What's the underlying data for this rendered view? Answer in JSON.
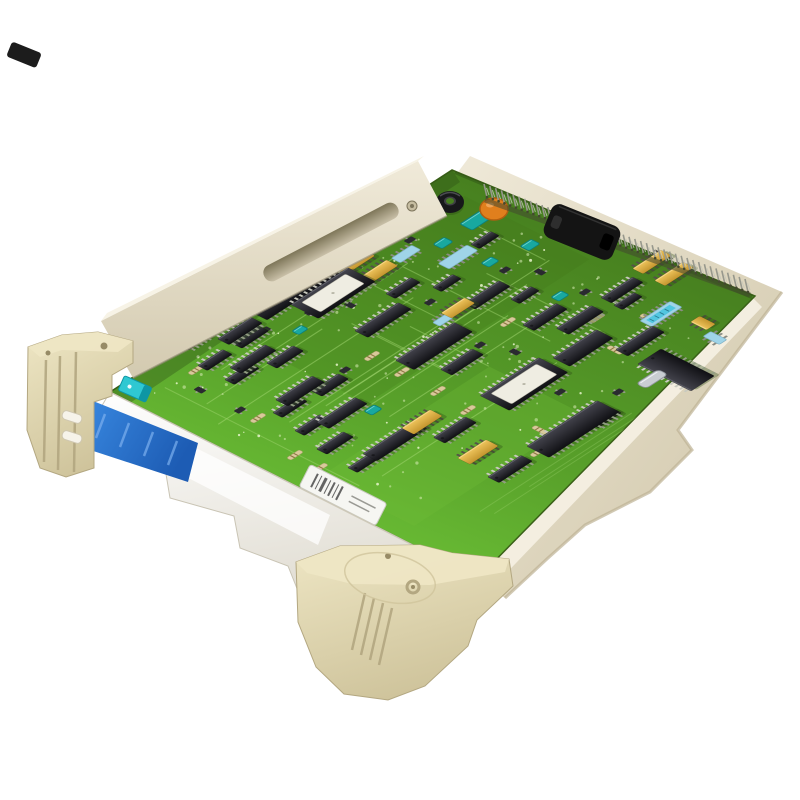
{
  "image": {
    "type": "product-photo",
    "subject": "industrial-plc-circuit-board-module",
    "background": "#ffffff"
  },
  "palette": {
    "board_top": "#47801f",
    "board_mid": "#58a02a",
    "board_front": "#6ec437",
    "board_edge": "#3a6018",
    "trace": "#a4d873",
    "pour_light": "#6fbe39",
    "pour_dark": "#3f7419",
    "via": "#d9edb7",
    "sparkle": "#e9f6cd",
    "shadow_green": "#2c4a14",
    "bracket_face1": "#f0ead9",
    "bracket_face2": "#d3cab0",
    "bracket_top": "#f7f3e6",
    "bracket_edge": "#8f8872",
    "slot_dark": "#7e7659",
    "slot_light": "#c9c0a8",
    "screw": "#c6bda1",
    "screw_dark": "#7d755c",
    "rail_east1": "#efe9d8",
    "rail_east2": "#cfc5a8",
    "rail_east_hi": "#f4efe1",
    "rail_east_shade": "#bdb294",
    "rail_front1": "#ffffff",
    "rail_front2": "#dfdbd0",
    "rail_front_glare": "#ffffff",
    "rail_front_edge": "#c9c4b4",
    "clip1": "#eee6c4",
    "clip2": "#cfc49c",
    "clip_line": "#b3a781",
    "clip_deep": "#978b66",
    "peg": "#f6f3ea",
    "peg_edge": "#cfc7b0",
    "pin": "#97988d",
    "pin_dark": "#43482f",
    "pin_light": "#c6c7ba",
    "handle": "#141414",
    "handle_hi": "#3a3a3a",
    "handle_notch": "#2e2e2e",
    "chip_top": "#44444d",
    "chip_bottom": "#101014",
    "chip_hi": "#6a6a74",
    "chip_pin": "#c9cabf",
    "yellow1": "#f0c65e",
    "yellow2": "#c4952e",
    "yellow_pin": "#55524a",
    "teal": "#18a8a0",
    "teal_dark": "#0d7f7a",
    "lightblue": "#9fd4e8",
    "lightblue_edge": "#7fb0c4",
    "cyanlabel": "#52c6e0",
    "cyanlabel_tick": "#2a7a90",
    "orange": "#e07f1d",
    "orange_dark": "#b05f10",
    "silver": "#c9cdd2",
    "silver_edge": "#8f959c",
    "resistor": "#d9c99b",
    "resistor_band": "#8a7340",
    "smd": "#2a2a30",
    "blue1": "#3a8ae2",
    "blue2": "#1d5cb4",
    "blue_streak": "#7cb0ef",
    "cyan_conn": "#2fc8d2",
    "cyan_conn_dark": "#0e96a4",
    "label_white": "#f6f6f2",
    "label_edge": "#c9c9c0",
    "barcode": "#4a4a4a",
    "rust": "#9c5b1c"
  },
  "geometry": {
    "board_corners": [
      [
        452,
        170
      ],
      [
        755,
        296
      ],
      [
        478,
        578
      ],
      [
        110,
        392
      ]
    ],
    "board_origin": [
      110,
      392
    ],
    "board_u": [
      342,
      -222
    ],
    "board_v": [
      368,
      186
    ],
    "pins": {
      "from": [
        487,
        197
      ],
      "to": [
        748,
        292
      ],
      "count": 46
    },
    "rail_east": [
      [
        458,
        172
      ],
      [
        752,
        297
      ],
      [
        478,
        578
      ],
      [
        505,
        598
      ],
      [
        548,
        558
      ],
      [
        585,
        525
      ],
      [
        650,
        492
      ],
      [
        692,
        450
      ],
      [
        678,
        430
      ],
      [
        708,
        390
      ],
      [
        782,
        292
      ],
      [
        470,
        156
      ]
    ],
    "rail_east_highlight": [
      [
        752,
        297
      ],
      [
        478,
        578
      ],
      [
        492,
        588
      ],
      [
        762,
        307
      ]
    ],
    "rail_front": [
      [
        110,
        392
      ],
      [
        478,
        578
      ],
      [
        462,
        630
      ],
      [
        400,
        610
      ],
      [
        372,
        628
      ],
      [
        300,
        596
      ],
      [
        288,
        566
      ],
      [
        240,
        548
      ],
      [
        234,
        516
      ],
      [
        170,
        498
      ],
      [
        165,
        468
      ],
      [
        80,
        443
      ]
    ],
    "rail_front_glare": [
      [
        150,
        425
      ],
      [
        330,
        515
      ],
      [
        318,
        545
      ],
      [
        138,
        452
      ]
    ],
    "bracket": {
      "face": [
        [
          418,
          161
        ],
        [
          447,
          216
        ],
        [
          133,
          378
        ],
        [
          101,
          321
        ]
      ],
      "top": [
        [
          418,
          161
        ],
        [
          424,
          156
        ],
        [
          107,
          313
        ],
        [
          101,
          321
        ]
      ],
      "slot": {
        "cx": 331,
        "cy": 242,
        "l": 150,
        "w": 17,
        "angle": -27.5
      },
      "screw": [
        412,
        206
      ]
    },
    "handle": {
      "cx": 582,
      "cy": 232,
      "l": 74,
      "w": 36,
      "angle": 22,
      "mount": [
        612,
        272
      ]
    },
    "blue_strip": [
      [
        88,
        399
      ],
      [
        198,
        443
      ],
      [
        188,
        482
      ],
      [
        78,
        446
      ]
    ],
    "cyan_connector": {
      "x": 135,
      "y": 389,
      "l": 30,
      "w": 16,
      "angle": 24
    },
    "clip_left": {
      "face": [
        [
          28,
          347
        ],
        [
          62,
          335
        ],
        [
          98,
          332
        ],
        [
          133,
          341
        ],
        [
          133,
          363
        ],
        [
          112,
          375
        ],
        [
          112,
          396
        ],
        [
          94,
          402
        ],
        [
          94,
          468
        ],
        [
          66,
          477
        ],
        [
          40,
          468
        ],
        [
          27,
          430
        ]
      ],
      "top": [
        [
          28,
          347
        ],
        [
          62,
          335
        ],
        [
          98,
          332
        ],
        [
          133,
          341
        ],
        [
          118,
          352
        ],
        [
          62,
          350
        ],
        [
          40,
          357
        ]
      ],
      "ribs": [
        [
          46,
          360,
          44,
          462
        ],
        [
          60,
          356,
          58,
          470
        ],
        [
          76,
          352,
          74,
          472
        ]
      ],
      "holes": [
        [
          104,
          346,
          3.5
        ],
        [
          48,
          353,
          2.5
        ]
      ],
      "pegs": [
        [
          72,
          417
        ],
        [
          72,
          437
        ]
      ],
      "peg_angle": 18
    },
    "clip_bottom": {
      "face": [
        [
          296,
          562
        ],
        [
          340,
          546
        ],
        [
          420,
          545
        ],
        [
          452,
          553
        ],
        [
          509,
          559
        ],
        [
          513,
          586
        ],
        [
          477,
          620
        ],
        [
          468,
          646
        ],
        [
          425,
          686
        ],
        [
          388,
          700
        ],
        [
          344,
          694
        ],
        [
          316,
          667
        ],
        [
          298,
          622
        ]
      ],
      "top": [
        [
          296,
          562
        ],
        [
          340,
          546
        ],
        [
          420,
          545
        ],
        [
          452,
          553
        ],
        [
          509,
          559
        ],
        [
          505,
          572
        ],
        [
          430,
          585
        ],
        [
          352,
          584
        ],
        [
          307,
          573
        ]
      ],
      "ribs": [
        [
          365,
          593,
          352,
          650
        ],
        [
          374,
          598,
          361,
          655
        ],
        [
          383,
          603,
          370,
          660
        ],
        [
          392,
          608,
          379,
          665
        ]
      ],
      "hole_small": [
        388,
        556,
        3
      ],
      "hole_ring": [
        413,
        587,
        6
      ],
      "plate": [
        390,
        578,
        46,
        24,
        12
      ]
    },
    "texture": {
      "seed": 11,
      "vias": 75,
      "sparkles": 42,
      "traces_u": 11,
      "traces_v": 8
    }
  },
  "components": [
    {
      "t": "res",
      "x": 168,
      "y": 345,
      "o": "u"
    },
    {
      "t": "res",
      "x": 196,
      "y": 370,
      "o": "u"
    },
    {
      "t": "res",
      "x": 258,
      "y": 418,
      "o": "u"
    },
    {
      "t": "res",
      "x": 372,
      "y": 356,
      "o": "u"
    },
    {
      "t": "res",
      "x": 402,
      "y": 372,
      "o": "u"
    },
    {
      "t": "res",
      "x": 478,
      "y": 300,
      "o": "u"
    },
    {
      "t": "res",
      "x": 508,
      "y": 322,
      "o": "u"
    },
    {
      "t": "res",
      "x": 597,
      "y": 318,
      "o": "u"
    },
    {
      "t": "res",
      "x": 438,
      "y": 391,
      "o": "u"
    },
    {
      "t": "res",
      "x": 468,
      "y": 410,
      "o": "u"
    },
    {
      "t": "res",
      "x": 538,
      "y": 452,
      "o": "u"
    },
    {
      "t": "res",
      "x": 320,
      "y": 468,
      "o": "u"
    },
    {
      "t": "res",
      "x": 295,
      "y": 455,
      "o": "u"
    },
    {
      "t": "res",
      "x": 540,
      "y": 430,
      "o": "v"
    },
    {
      "t": "res",
      "x": 615,
      "y": 350,
      "o": "v"
    },
    {
      "t": "res",
      "x": 648,
      "y": 318,
      "o": "v"
    },
    {
      "t": "smd",
      "x": 410,
      "y": 240,
      "o": "u"
    },
    {
      "t": "smd",
      "x": 365,
      "y": 285,
      "o": "u"
    },
    {
      "t": "smd",
      "x": 505,
      "y": 270,
      "o": "u"
    },
    {
      "t": "smd",
      "x": 540,
      "y": 272,
      "o": "v"
    },
    {
      "t": "smd",
      "x": 585,
      "y": 292,
      "o": "u"
    },
    {
      "t": "smd",
      "x": 430,
      "y": 302,
      "o": "u"
    },
    {
      "t": "smd",
      "x": 350,
      "y": 305,
      "o": "v"
    },
    {
      "t": "smd",
      "x": 310,
      "y": 312,
      "o": "u"
    },
    {
      "t": "smd",
      "x": 265,
      "y": 330,
      "o": "u"
    },
    {
      "t": "smd",
      "x": 480,
      "y": 345,
      "o": "u"
    },
    {
      "t": "smd",
      "x": 515,
      "y": 352,
      "o": "v"
    },
    {
      "t": "smd",
      "x": 560,
      "y": 392,
      "o": "u"
    },
    {
      "t": "smd",
      "x": 618,
      "y": 392,
      "o": "u"
    },
    {
      "t": "smd",
      "x": 345,
      "y": 370,
      "o": "u"
    },
    {
      "t": "smd",
      "x": 240,
      "y": 410,
      "o": "u"
    },
    {
      "t": "smd",
      "x": 200,
      "y": 390,
      "o": "v"
    },
    {
      "t": "teal",
      "x": 477,
      "y": 220,
      "l": 26,
      "w": 14,
      "o": "u"
    },
    {
      "t": "teal",
      "x": 443,
      "y": 243,
      "l": 13,
      "w": 10,
      "o": "u"
    },
    {
      "t": "teal",
      "x": 530,
      "y": 245,
      "l": 13,
      "w": 10,
      "o": "u"
    },
    {
      "t": "teal",
      "x": 373,
      "y": 410,
      "l": 12,
      "w": 9,
      "o": "u"
    },
    {
      "t": "teal",
      "x": 560,
      "y": 296,
      "l": 12,
      "w": 9,
      "o": "u"
    },
    {
      "t": "teal",
      "x": 300,
      "y": 330,
      "l": 11,
      "w": 8,
      "o": "u"
    },
    {
      "t": "teal",
      "x": 490,
      "y": 262,
      "l": 12,
      "w": 9,
      "o": "u"
    },
    {
      "t": "lblue",
      "x": 458,
      "y": 257,
      "l": 34,
      "w": 12,
      "o": "u"
    },
    {
      "t": "lblue",
      "x": 406,
      "y": 254,
      "l": 24,
      "w": 10,
      "o": "u"
    },
    {
      "t": "lblue2",
      "x": 661,
      "y": 314,
      "l": 36,
      "w": 13,
      "o": "u"
    },
    {
      "t": "lblue",
      "x": 715,
      "y": 338,
      "l": 18,
      "w": 9,
      "o": "v"
    },
    {
      "t": "lblue",
      "x": 443,
      "y": 320,
      "l": 16,
      "w": 8,
      "o": "u"
    },
    {
      "t": "dip",
      "x": 218,
      "y": 323,
      "l": 32,
      "w": 12,
      "o": "u"
    },
    {
      "t": "dip",
      "x": 250,
      "y": 337,
      "l": 32,
      "w": 12,
      "o": "u"
    },
    {
      "t": "dip",
      "x": 215,
      "y": 360,
      "l": 30,
      "w": 11,
      "o": "u"
    },
    {
      "t": "dip",
      "x": 242,
      "y": 374,
      "l": 30,
      "w": 11,
      "o": "u"
    },
    {
      "t": "dip",
      "x": 285,
      "y": 357,
      "l": 32,
      "w": 12,
      "o": "u"
    },
    {
      "t": "dip",
      "x": 330,
      "y": 385,
      "l": 32,
      "w": 12,
      "o": "u"
    },
    {
      "t": "dip",
      "x": 290,
      "y": 407,
      "l": 30,
      "w": 11,
      "o": "u"
    },
    {
      "t": "dip",
      "x": 335,
      "y": 443,
      "l": 32,
      "w": 12,
      "o": "u"
    },
    {
      "t": "dip",
      "x": 312,
      "y": 425,
      "l": 30,
      "w": 11,
      "o": "u"
    },
    {
      "t": "dip",
      "x": 270,
      "y": 300,
      "l": 30,
      "w": 11,
      "o": "u"
    },
    {
      "t": "dip",
      "x": 195,
      "y": 341,
      "l": 26,
      "w": 10,
      "o": "u"
    },
    {
      "t": "dip",
      "x": 365,
      "y": 462,
      "l": 30,
      "w": 11,
      "o": "u"
    },
    {
      "t": "dip",
      "x": 485,
      "y": 240,
      "l": 24,
      "w": 10,
      "o": "u"
    },
    {
      "t": "dip",
      "x": 403,
      "y": 288,
      "l": 30,
      "w": 11,
      "o": "u"
    },
    {
      "t": "dip",
      "x": 447,
      "y": 283,
      "l": 24,
      "w": 10,
      "o": "u"
    },
    {
      "t": "dip",
      "x": 525,
      "y": 295,
      "l": 24,
      "w": 10,
      "o": "u"
    },
    {
      "t": "dip",
      "x": 605,
      "y": 418,
      "l": 28,
      "w": 11,
      "o": "u"
    },
    {
      "t": "dip",
      "x": 628,
      "y": 301,
      "l": 24,
      "w": 10,
      "o": "u"
    },
    {
      "t": "dip",
      "x": 383,
      "y": 320,
      "l": 52,
      "w": 15,
      "o": "u"
    },
    {
      "t": "dip",
      "x": 640,
      "y": 341,
      "l": 44,
      "w": 14,
      "o": "u"
    },
    {
      "t": "dip",
      "x": 487,
      "y": 295,
      "l": 42,
      "w": 13,
      "o": "u"
    },
    {
      "t": "dip",
      "x": 545,
      "y": 317,
      "l": 40,
      "w": 13,
      "o": "u"
    },
    {
      "t": "dip",
      "x": 395,
      "y": 441,
      "l": 60,
      "w": 16,
      "o": "u"
    },
    {
      "t": "dip",
      "x": 510,
      "y": 469,
      "l": 40,
      "w": 13,
      "o": "u"
    },
    {
      "t": "dip",
      "x": 300,
      "y": 391,
      "l": 44,
      "w": 14,
      "o": "u"
    },
    {
      "t": "dip",
      "x": 342,
      "y": 413,
      "l": 46,
      "w": 14,
      "o": "u"
    },
    {
      "t": "dip",
      "x": 253,
      "y": 359,
      "l": 42,
      "w": 13,
      "o": "u"
    },
    {
      "t": "dip",
      "x": 622,
      "y": 290,
      "l": 38,
      "w": 12,
      "o": "u"
    },
    {
      "t": "dip",
      "x": 455,
      "y": 430,
      "l": 38,
      "w": 13,
      "o": "u"
    },
    {
      "t": "dip",
      "x": 240,
      "y": 331,
      "l": 40,
      "w": 13,
      "o": "u"
    },
    {
      "t": "dip",
      "x": 580,
      "y": 320,
      "l": 42,
      "w": 14,
      "o": "u"
    },
    {
      "t": "dip",
      "x": 462,
      "y": 362,
      "l": 38,
      "w": 13,
      "o": "u"
    },
    {
      "t": "ydip",
      "x": 355,
      "y": 262,
      "l": 34,
      "w": 13,
      "o": "u"
    },
    {
      "t": "ydip",
      "x": 378,
      "y": 272,
      "l": 34,
      "w": 13,
      "o": "u"
    },
    {
      "t": "ydip",
      "x": 652,
      "y": 262,
      "l": 34,
      "w": 12,
      "o": "u"
    },
    {
      "t": "ydip",
      "x": 674,
      "y": 274,
      "l": 34,
      "w": 12,
      "o": "u"
    },
    {
      "t": "ydip",
      "x": 422,
      "y": 422,
      "l": 34,
      "w": 14,
      "o": "u"
    },
    {
      "t": "ydip",
      "x": 478,
      "y": 452,
      "l": 34,
      "w": 14,
      "o": "u"
    },
    {
      "t": "ydip",
      "x": 458,
      "y": 308,
      "l": 28,
      "w": 12,
      "o": "u"
    },
    {
      "t": "ydip",
      "x": 703,
      "y": 323,
      "l": 18,
      "w": 11,
      "o": "v"
    },
    {
      "t": "dip",
      "x": 292,
      "y": 291,
      "l": 86,
      "w": 25,
      "o": "u"
    },
    {
      "t": "dip",
      "x": 573,
      "y": 429,
      "l": 84,
      "w": 25,
      "o": "u"
    },
    {
      "t": "dip",
      "x": 676,
      "y": 370,
      "l": 60,
      "w": 28,
      "o": "v"
    },
    {
      "t": "dip",
      "x": 434,
      "y": 346,
      "l": 70,
      "w": 21,
      "o": "u"
    },
    {
      "t": "dip",
      "x": 583,
      "y": 348,
      "l": 52,
      "w": 19,
      "o": "u"
    },
    {
      "t": "ep",
      "x": 333,
      "y": 293,
      "l": 68,
      "w": 31,
      "o": "u"
    },
    {
      "t": "ep",
      "x": 524,
      "y": 384,
      "l": 70,
      "w": 33,
      "o": "u"
    },
    {
      "t": "toroid",
      "x": 450,
      "y": 202
    },
    {
      "t": "disc",
      "x": 494,
      "y": 209
    },
    {
      "t": "ecap",
      "x": 421,
      "y": 209
    },
    {
      "t": "xtal",
      "x": 652,
      "y": 379,
      "l": 26,
      "w": 11,
      "o": "u"
    },
    {
      "t": "rust",
      "x": 352,
      "y": 526,
      "l": 10,
      "w": 8,
      "angle": 27
    },
    {
      "t": "label",
      "x": 343,
      "y": 495,
      "l": 86,
      "w": 25,
      "angle": 27
    }
  ]
}
